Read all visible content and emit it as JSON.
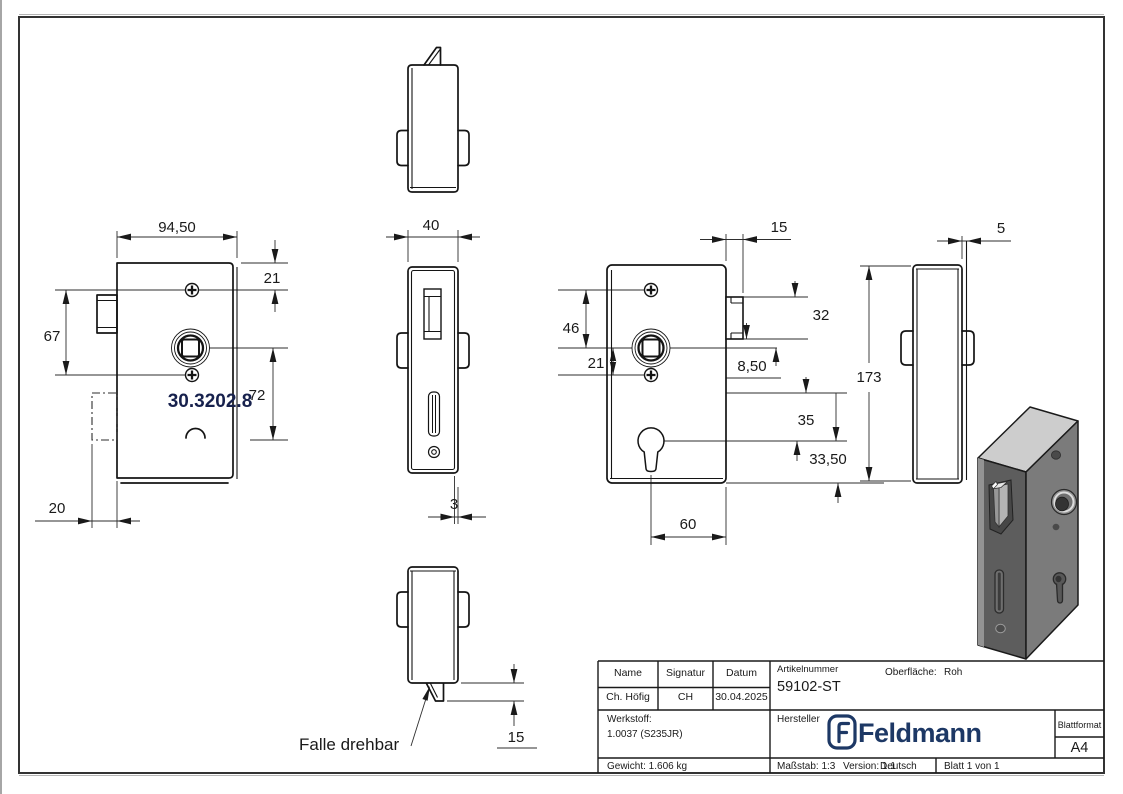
{
  "drawing": {
    "back_view": {
      "width": "94,50",
      "top_to_screw": "21",
      "screw_span": "67",
      "spindle_to_keyhole": "72",
      "latch_depth": "20",
      "part_number": "30.3202.8"
    },
    "faceplate_view": {
      "width": "40",
      "thickness": "3"
    },
    "bottom_view": {
      "latch_protrusion": "15",
      "note": "Falle drehbar"
    },
    "front_view": {
      "latch_protrusion": "15",
      "screw_to_spindle": "46",
      "spindle_to_screw": "21",
      "latch_height": "32",
      "latch_to_spindle": "8,50",
      "keyhole_offset": "35",
      "keyhole_to_bottom": "33,50",
      "keyhole_x": "60"
    },
    "side_view": {
      "height": "173",
      "faceplate_thickness": "5"
    }
  },
  "title_block": {
    "name_label": "Name",
    "signatur_label": "Signatur",
    "datum_label": "Datum",
    "name": "Ch. Höfig",
    "signatur": "CH",
    "datum": "30.04.2025",
    "artikelnummer_label": "Artikelnummer",
    "artikelnummer": "59102-ST",
    "oberflaeche_label": "Oberfläche:",
    "oberflaeche_value": "Roh",
    "werkstoff_label": "Werkstoff:",
    "werkstoff_value": "1.0037 (S235JR)",
    "hersteller_label": "Hersteller",
    "brand": "Feldmann",
    "brand_color": "#1d3865",
    "blattformat_label": "Blattformat",
    "blattformat_value": "A4",
    "gewicht": "Gewicht: 1.606 kg",
    "massstab": "Maßstab: 1:3",
    "version": "Version: 1.1",
    "sprache": "Deutsch",
    "blatt": "Blatt 1 von 1"
  }
}
